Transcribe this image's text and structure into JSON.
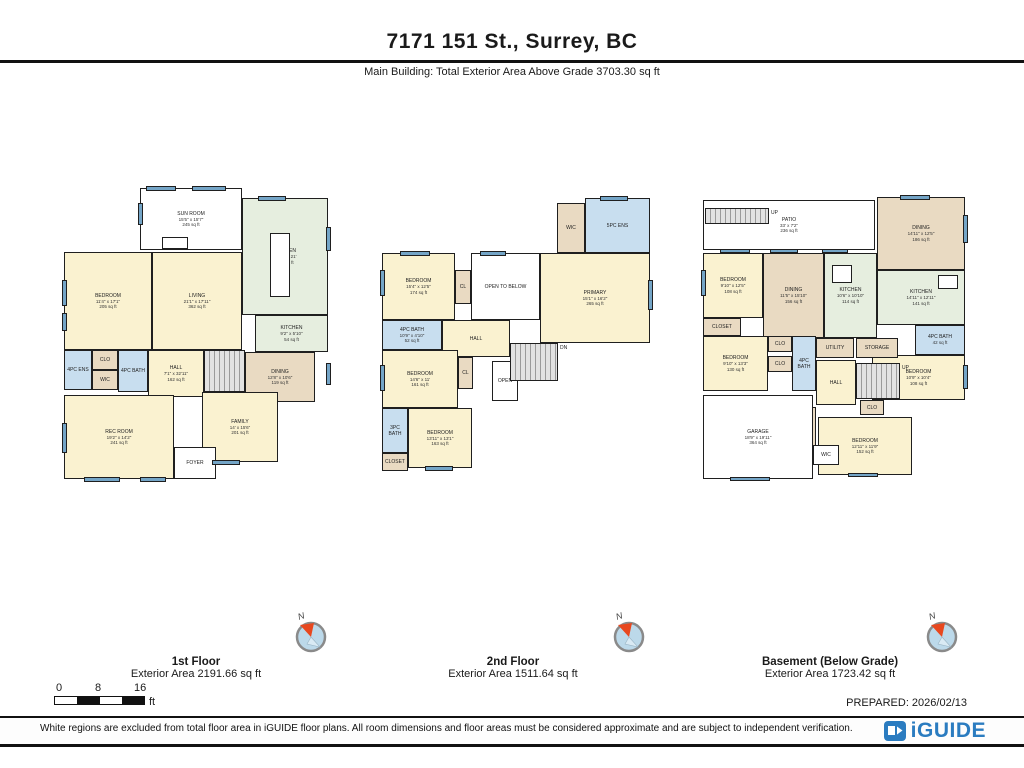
{
  "header": {
    "title": "7171 151 St., Surrey, BC",
    "subtitle": "Main Building: Total Exterior Area Above Grade 3703.30 sq ft"
  },
  "palette": {
    "cream": "#FAF2D0",
    "green": "#E6EEDF",
    "tan": "#E9DAC2",
    "blue": "#C8DEEF",
    "white": "#FFFFFF",
    "window": "#74A5C7",
    "stair": "#DCDCDC",
    "wall": "#1F1F1F",
    "accent": "#2B7CC0"
  },
  "floors": [
    {
      "label": "1st Floor",
      "area_label": "Exterior Area 2191.66 sq ft",
      "box": {
        "x": 62,
        "y": 185,
        "w": 268,
        "h": 310
      },
      "rooms": [
        {
          "name": "SUN ROOM",
          "dims": "15'5\" x 15'7\"",
          "area": "245 sq ft",
          "x": 78,
          "y": 3,
          "w": 102,
          "h": 62,
          "c": "white"
        },
        {
          "name": "KITCHEN",
          "dims": "15'10\" x 21'",
          "area": "367 sq ft",
          "x": 180,
          "y": 13,
          "w": 86,
          "h": 117,
          "c": "green"
        },
        {
          "name": "BEDROOM",
          "dims": "11'4\" x 17'1\"",
          "area": "205 sq ft",
          "x": 2,
          "y": 67,
          "w": 88,
          "h": 98,
          "c": "cream"
        },
        {
          "name": "LIVING",
          "dims": "21'1\" x 17'11\"",
          "area": "362 sq ft",
          "x": 90,
          "y": 67,
          "w": 90,
          "h": 98,
          "c": "cream"
        },
        {
          "name": "KITCHEN",
          "dims": "9'2\" x 5'10\"",
          "area": "54 sq ft",
          "x": 193,
          "y": 130,
          "w": 73,
          "h": 37,
          "c": "green"
        },
        {
          "name": "DINING",
          "dims": "12'8\" x 10'6\"",
          "area": "119 sq ft",
          "x": 183,
          "y": 167,
          "w": 70,
          "h": 50,
          "c": "tan"
        },
        {
          "name": "4PC ENS",
          "x": 2,
          "y": 165,
          "w": 28,
          "h": 40,
          "c": "blue"
        },
        {
          "name": "CLO",
          "x": 30,
          "y": 165,
          "w": 26,
          "h": 20,
          "c": "tan"
        },
        {
          "name": "WIC",
          "x": 30,
          "y": 185,
          "w": 26,
          "h": 20,
          "c": "tan"
        },
        {
          "name": "4PC BATH",
          "x": 56,
          "y": 165,
          "w": 30,
          "h": 42,
          "c": "blue"
        },
        {
          "name": "HALL",
          "dims": "7'1\" x 32'11\"",
          "area": "162 sq ft",
          "x": 86,
          "y": 165,
          "w": 56,
          "h": 47,
          "c": "cream"
        },
        {
          "name": "REC ROOM",
          "dims": "19'2\" x 14'2\"",
          "area": "241 sq ft",
          "x": 2,
          "y": 210,
          "w": 110,
          "h": 84,
          "c": "cream"
        },
        {
          "name": "FAMILY",
          "dims": "14' x 15'6\"",
          "area": "201 sq ft",
          "x": 140,
          "y": 207,
          "w": 76,
          "h": 70,
          "c": "cream"
        },
        {
          "name": "FOYER",
          "x": 112,
          "y": 262,
          "w": 42,
          "h": 32,
          "c": "white"
        }
      ],
      "stairs": [
        {
          "x": 142,
          "y": 165,
          "w": 41,
          "h": 42,
          "label": ""
        }
      ],
      "boxes": [
        {
          "x": 208,
          "y": 48,
          "w": 20,
          "h": 64
        },
        {
          "x": 100,
          "y": 52,
          "w": 26,
          "h": 12
        }
      ],
      "windows": [
        {
          "x": 84,
          "y": 1,
          "w": 30,
          "h": 5
        },
        {
          "x": 130,
          "y": 1,
          "w": 34,
          "h": 5
        },
        {
          "x": 76,
          "y": 18,
          "w": 5,
          "h": 22
        },
        {
          "x": 196,
          "y": 11,
          "w": 28,
          "h": 5
        },
        {
          "x": 0,
          "y": 95,
          "w": 5,
          "h": 26
        },
        {
          "x": 0,
          "y": 128,
          "w": 5,
          "h": 18
        },
        {
          "x": 0,
          "y": 238,
          "w": 5,
          "h": 30
        },
        {
          "x": 22,
          "y": 292,
          "w": 36,
          "h": 5
        },
        {
          "x": 78,
          "y": 292,
          "w": 26,
          "h": 5
        },
        {
          "x": 150,
          "y": 275,
          "w": 28,
          "h": 5
        },
        {
          "x": 264,
          "y": 42,
          "w": 5,
          "h": 24
        },
        {
          "x": 264,
          "y": 178,
          "w": 5,
          "h": 22
        }
      ]
    },
    {
      "label": "2nd Floor",
      "area_label": "Exterior Area 1511.64 sq ft",
      "box": {
        "x": 380,
        "y": 195,
        "w": 272,
        "h": 285
      },
      "rooms": [
        {
          "name": "WIC",
          "x": 177,
          "y": 8,
          "w": 28,
          "h": 50,
          "c": "tan"
        },
        {
          "name": "5PC ENS",
          "x": 205,
          "y": 3,
          "w": 65,
          "h": 55,
          "c": "blue"
        },
        {
          "name": "PRIMARY",
          "dims": "15'1\" x 16'2\"",
          "area": "265 sq ft",
          "x": 160,
          "y": 58,
          "w": 110,
          "h": 90,
          "c": "cream"
        },
        {
          "name": "BEDROOM",
          "dims": "15'4\" x 12'5\"",
          "area": "174 sq ft",
          "x": 2,
          "y": 58,
          "w": 73,
          "h": 67,
          "c": "cream"
        },
        {
          "name": "CL",
          "x": 75,
          "y": 75,
          "w": 16,
          "h": 34,
          "c": "tan"
        },
        {
          "name": "OPEN TO BELOW",
          "x": 91,
          "y": 58,
          "w": 69,
          "h": 67,
          "c": "white"
        },
        {
          "name": "4PC BATH",
          "dims": "10'9\" x 4'10\"",
          "area": "52 sq ft",
          "x": 2,
          "y": 125,
          "w": 60,
          "h": 30,
          "c": "blue"
        },
        {
          "name": "HALL",
          "x": 62,
          "y": 125,
          "w": 68,
          "h": 37,
          "c": "cream"
        },
        {
          "name": "BEDROOM",
          "dims": "14'6\" x 11'",
          "area": "161 sq ft",
          "x": 2,
          "y": 155,
          "w": 76,
          "h": 58,
          "c": "cream"
        },
        {
          "name": "CL",
          "x": 78,
          "y": 162,
          "w": 15,
          "h": 32,
          "c": "tan"
        },
        {
          "name": "OPEN",
          "x": 112,
          "y": 166,
          "w": 26,
          "h": 40,
          "c": "white"
        },
        {
          "name": "BEDROOM",
          "dims": "13'11\" x 13'1\"",
          "area": "163 sq ft",
          "x": 28,
          "y": 213,
          "w": 64,
          "h": 60,
          "c": "cream"
        },
        {
          "name": "CLOSET",
          "x": 2,
          "y": 258,
          "w": 26,
          "h": 18,
          "c": "tan"
        },
        {
          "name": "3PC BATH",
          "x": 2,
          "y": 213,
          "w": 26,
          "h": 45,
          "c": "blue"
        }
      ],
      "stairs": [
        {
          "x": 130,
          "y": 148,
          "w": 48,
          "h": 38,
          "label": "DN"
        }
      ],
      "boxes": [],
      "windows": [
        {
          "x": 20,
          "y": 56,
          "w": 30,
          "h": 5
        },
        {
          "x": 100,
          "y": 56,
          "w": 26,
          "h": 5
        },
        {
          "x": 268,
          "y": 85,
          "w": 5,
          "h": 30
        },
        {
          "x": 220,
          "y": 1,
          "w": 28,
          "h": 5
        },
        {
          "x": 0,
          "y": 75,
          "w": 5,
          "h": 26
        },
        {
          "x": 0,
          "y": 170,
          "w": 5,
          "h": 26
        },
        {
          "x": 45,
          "y": 271,
          "w": 28,
          "h": 5
        }
      ]
    },
    {
      "label": "Basement (Below Grade)",
      "area_label": "Exterior Area 1723.42 sq ft",
      "box": {
        "x": 700,
        "y": 195,
        "w": 268,
        "h": 290
      },
      "rooms": [
        {
          "name": "PATIO",
          "dims": "33' x 7'2\"",
          "area": "236 sq ft",
          "x": 3,
          "y": 5,
          "w": 172,
          "h": 50,
          "c": "white"
        },
        {
          "name": "DINING",
          "dims": "14'11\" x 12'5\"",
          "area": "186 sq ft",
          "x": 177,
          "y": 2,
          "w": 88,
          "h": 73,
          "c": "tan"
        },
        {
          "name": "BEDROOM",
          "dims": "9'10\" x 12'5\"",
          "area": "108 sq ft",
          "x": 3,
          "y": 58,
          "w": 60,
          "h": 65,
          "c": "cream"
        },
        {
          "name": "CLOSET",
          "x": 3,
          "y": 123,
          "w": 38,
          "h": 18,
          "c": "tan"
        },
        {
          "name": "DINING",
          "dims": "11'5\" x 15'10\"",
          "area": "156 sq ft",
          "x": 63,
          "y": 58,
          "w": 61,
          "h": 85,
          "c": "tan"
        },
        {
          "name": "KITCHEN",
          "dims": "10'6\" x 10'10\"",
          "area": "114 sq ft",
          "x": 124,
          "y": 58,
          "w": 53,
          "h": 85,
          "c": "green"
        },
        {
          "name": "KITCHEN",
          "dims": "14'11\" x 12'11\"",
          "area": "141 sq ft",
          "x": 177,
          "y": 75,
          "w": 88,
          "h": 55,
          "c": "green"
        },
        {
          "name": "4PC BATH",
          "area": "42 sq ft",
          "x": 215,
          "y": 130,
          "w": 50,
          "h": 30,
          "c": "blue"
        },
        {
          "name": "BEDROOM",
          "dims": "10'9\" x 10'4\"",
          "area": "108 sq ft",
          "x": 172,
          "y": 160,
          "w": 93,
          "h": 45,
          "c": "cream"
        },
        {
          "name": "BEDROOM",
          "dims": "9'10\" x 13'3\"",
          "area": "130 sq ft",
          "x": 3,
          "y": 141,
          "w": 65,
          "h": 55,
          "c": "cream"
        },
        {
          "name": "CLO",
          "x": 68,
          "y": 141,
          "w": 24,
          "h": 16,
          "c": "tan"
        },
        {
          "name": "CLO",
          "x": 68,
          "y": 161,
          "w": 24,
          "h": 16,
          "c": "tan"
        },
        {
          "name": "4PC BATH",
          "x": 92,
          "y": 141,
          "w": 24,
          "h": 55,
          "c": "blue"
        },
        {
          "name": "UTILITY",
          "x": 116,
          "y": 143,
          "w": 38,
          "h": 20,
          "c": "tan"
        },
        {
          "name": "STORAGE",
          "x": 156,
          "y": 143,
          "w": 42,
          "h": 20,
          "c": "tan"
        },
        {
          "name": "HALL",
          "x": 116,
          "y": 165,
          "w": 40,
          "h": 45,
          "c": "cream"
        },
        {
          "name": "CLO",
          "x": 160,
          "y": 205,
          "w": 24,
          "h": 15,
          "c": "tan"
        },
        {
          "name": "BEDROOM",
          "dims": "12'11\" x 11'9\"",
          "area": "152 sq ft",
          "x": 118,
          "y": 222,
          "w": 94,
          "h": 58,
          "c": "cream"
        },
        {
          "name": "LAUNDRY",
          "x": 94,
          "y": 212,
          "w": 22,
          "h": 52,
          "c": "tan",
          "v": true
        },
        {
          "name": "GARAGE",
          "dims": "18'9\" x 19'11\"",
          "area": "364 sq ft",
          "x": 3,
          "y": 200,
          "w": 110,
          "h": 84,
          "c": "white"
        },
        {
          "name": "WIC",
          "x": 113,
          "y": 250,
          "w": 26,
          "h": 20,
          "c": "white"
        }
      ],
      "stairs": [
        {
          "x": 156,
          "y": 168,
          "w": 44,
          "h": 36,
          "label": "UP"
        },
        {
          "x": 5,
          "y": 13,
          "w": 64,
          "h": 16,
          "label": "UP"
        }
      ],
      "boxes": [
        {
          "x": 132,
          "y": 70,
          "w": 20,
          "h": 18
        },
        {
          "x": 238,
          "y": 80,
          "w": 20,
          "h": 14
        }
      ],
      "windows": [
        {
          "x": 20,
          "y": 54,
          "w": 30,
          "h": 4
        },
        {
          "x": 70,
          "y": 54,
          "w": 28,
          "h": 4
        },
        {
          "x": 122,
          "y": 54,
          "w": 26,
          "h": 4
        },
        {
          "x": 200,
          "y": 0,
          "w": 30,
          "h": 5
        },
        {
          "x": 263,
          "y": 20,
          "w": 5,
          "h": 28
        },
        {
          "x": 263,
          "y": 170,
          "w": 5,
          "h": 24
        },
        {
          "x": 1,
          "y": 75,
          "w": 5,
          "h": 26
        },
        {
          "x": 148,
          "y": 278,
          "w": 30,
          "h": 4
        },
        {
          "x": 30,
          "y": 282,
          "w": 40,
          "h": 4
        }
      ]
    }
  ],
  "scale_bar": {
    "ticks": [
      "0",
      "8",
      "16"
    ],
    "unit": "ft"
  },
  "footer": {
    "prepared": "PREPARED: 2026/02/13",
    "disclaimer": "White regions are excluded from total floor area in iGUIDE floor plans. All room dimensions and floor areas must be considered approximate and are subject to independent verification.",
    "brand": "iGUIDE"
  }
}
